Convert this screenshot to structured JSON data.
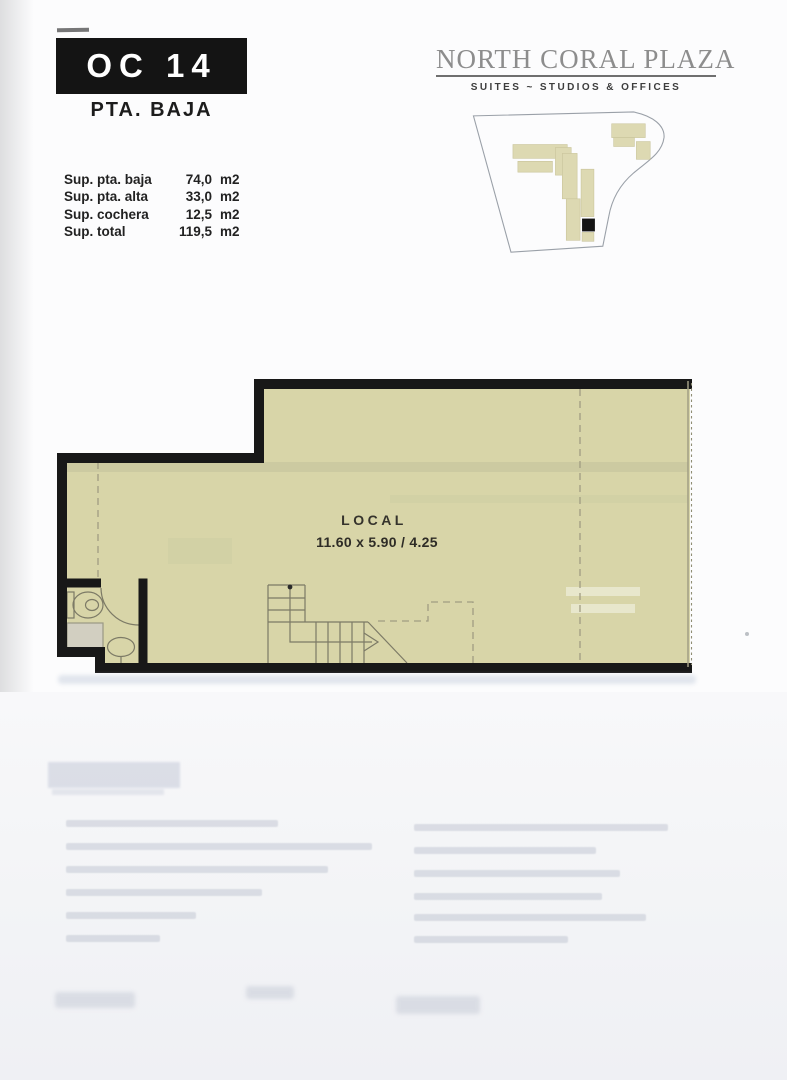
{
  "unit": {
    "code": "OC 14",
    "floor": "PTA. BAJA"
  },
  "surfaces": [
    {
      "label": "Sup. pta. baja",
      "value": "74,0",
      "unit": "m2"
    },
    {
      "label": "Sup. pta. alta",
      "value": "33,0",
      "unit": "m2"
    },
    {
      "label": "Sup. cochera",
      "value": "12,5",
      "unit": "m2"
    },
    {
      "label": "Sup. total",
      "value": "119,5",
      "unit": "m2"
    }
  ],
  "brand": {
    "name": "NORTH CORAL PLAZA",
    "tagline": "SUITES ~ STUDIOS & OFFICES"
  },
  "floorplan": {
    "room_label": "LOCAL",
    "room_dimensions": "11.60 x 5.90 / 4.25"
  },
  "colors": {
    "plan_fill": "#d8d5a8",
    "wall_black": "#181818",
    "thin_line": "#7c7a66",
    "dashed_line": "#a09d82",
    "building_fill": "#ddd9b2",
    "unit_highlight": "#141414",
    "logo_gray": "#8d8d8d"
  }
}
